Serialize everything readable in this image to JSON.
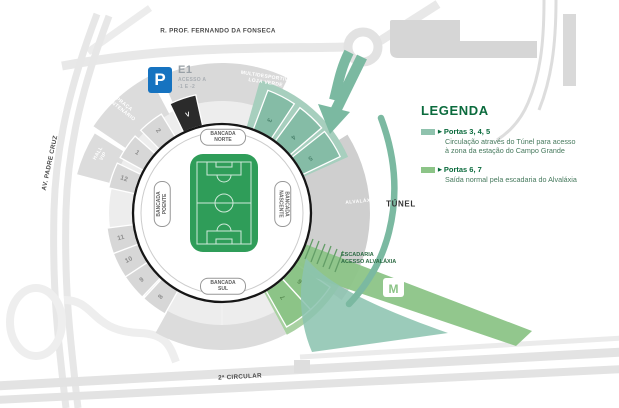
{
  "colors": {
    "wedge": {
      "gray": "#d7d7d7",
      "teal": "#85bca6",
      "green": "#8cc487",
      "black": "#2b2b2b"
    },
    "gate_text": {
      "gray": "#8d8d8d",
      "teal": "#4e8670",
      "green": "#578b51",
      "black": "#ffffff"
    },
    "zone_teal": "#a7cfbe",
    "zone_green": "#a9d1a2",
    "tunnel_teal": "#7bb9a1",
    "band_green": "#8cc487",
    "exit_teal": "#8cc3b0",
    "pitch_green": "#2f9d59",
    "parking_blue": "#1673c0",
    "legend_green": "#0b6b3d"
  },
  "roads": {
    "top": "R. PROF. FERNANDO DA FONSECA",
    "left": "AV. PADRE CRUZ",
    "bottom": "2ª CIRCULAR",
    "tunnel": "TÚNEL"
  },
  "parking": {
    "symbol": "P",
    "code": "E1",
    "access_line1": "ACESSO A",
    "access_line2": "-1 E -2"
  },
  "areas": {
    "praca_line1": "PRAÇA",
    "praca_line2": "CENTENÁRIO",
    "hall_line1": "HALL",
    "hall_line2": "VIP",
    "multi_line1": "MULTIDESPORTIVO",
    "multi_line2": "LOJA VERDE",
    "alvalaxia": "ALVALÁXIA",
    "escadaria_line1": "ESCADARIA",
    "escadaria_line2": "ACESSO ALVALÁXIA"
  },
  "stadium": {
    "stands": {
      "north": [
        "BANCADA",
        "NORTE"
      ],
      "south": [
        "BANCADA",
        "SUL"
      ],
      "west": [
        "BANCADA",
        "POENTE"
      ],
      "east": [
        "BANCADA",
        "NASCENTE"
      ]
    },
    "gates": [
      {
        "label": "V",
        "angle": -19,
        "kind": "black"
      },
      {
        "label": "2",
        "angle": -38,
        "kind": "gray"
      },
      {
        "label": "1",
        "angle": -55,
        "kind": "gray"
      },
      {
        "label": "12",
        "angle": -71,
        "kind": "gray"
      },
      {
        "label": "11",
        "angle": -104,
        "kind": "gray"
      },
      {
        "label": "10",
        "angle": -117,
        "kind": "gray"
      },
      {
        "label": "9",
        "angle": -130,
        "kind": "gray"
      },
      {
        "label": "8",
        "angle": -144,
        "kind": "gray"
      },
      {
        "label": "3",
        "angle": 27,
        "kind": "teal"
      },
      {
        "label": "4",
        "angle": 43,
        "kind": "teal"
      },
      {
        "label": "5",
        "angle": 58,
        "kind": "teal"
      },
      {
        "label": "6",
        "angle": 131,
        "kind": "green"
      },
      {
        "label": "7",
        "angle": 144,
        "kind": "green"
      }
    ]
  },
  "legend": {
    "title": "LEGENDA",
    "entries": [
      {
        "marker": "▶",
        "title": "Portas 3, 4, 5",
        "desc1": "Circulação através do Túnel para acesso",
        "desc2": "à zona da estação do Campo Grande",
        "swatch": "#8fc2ad"
      },
      {
        "marker": "▶",
        "title": "Portas 6, 7",
        "desc1": "Saída normal pela escadaria do Alvaláxia",
        "desc2": "",
        "swatch": "#8cc487"
      }
    ]
  },
  "metro_icon": "M"
}
